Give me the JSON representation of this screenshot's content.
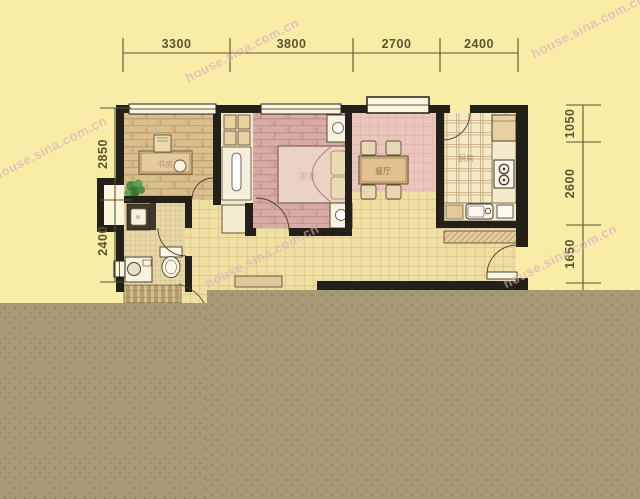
{
  "watermark": {
    "text": "house.sina.com.cn"
  },
  "dimensions_mm": {
    "top": [
      "3300",
      "3800",
      "2700",
      "2400"
    ],
    "left": [
      "2850",
      "2400"
    ],
    "right": [
      "1050",
      "2600",
      "1650"
    ]
  },
  "room_labels": {
    "study": "书房",
    "bedroom": "卧室",
    "dining": "餐厅",
    "kitchen": "厨房"
  },
  "colors": {
    "background": "#f7eda7",
    "censor_band": "#a79a77",
    "walls": "#23201a",
    "dimension_text": "#5d5430",
    "watermark_text": "#d9aab6",
    "bedroom_floor": "#d8aca6",
    "living_floor": "#f0dfa3",
    "study_floor": "#d9bf8d"
  }
}
